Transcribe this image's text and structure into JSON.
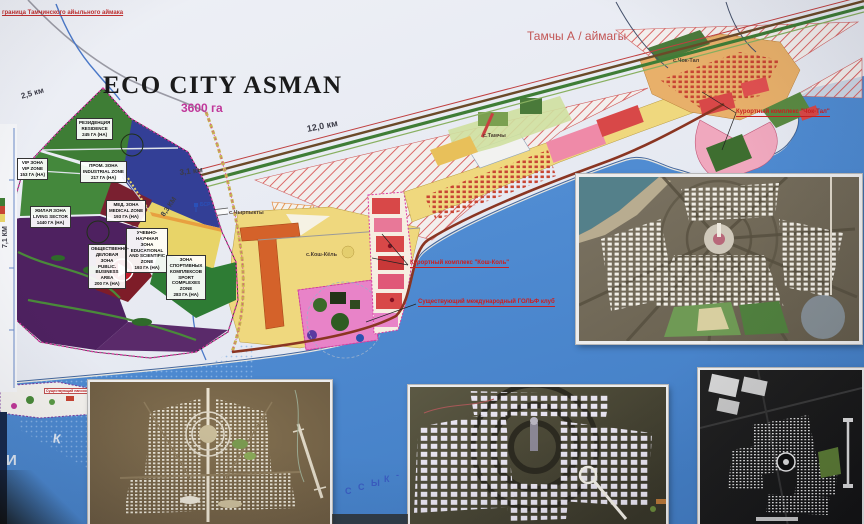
{
  "header": {
    "title": "ECO CITY ASMAN",
    "area": "3600 га",
    "region_label": "Тамчы А / аймагы",
    "boundary_note": "граница Тамчинского айыльного аймака"
  },
  "zones": {
    "residence": {
      "ru": "РЕЗИДЕНЦИЯ",
      "en": "RESIDENCE",
      "area": "245 ГА (НА)"
    },
    "vip": {
      "ru": "VIP ЗОНА",
      "en": "VIP ZONE",
      "area": "153 ГА (НА)"
    },
    "industrial": {
      "ru": "ПРОМ. ЗОНА",
      "en": "INDUSTRIAL ZONE",
      "area": "217 ГА (НА)"
    },
    "living": {
      "ru": "ЖИЛАЯ ЗОНА",
      "en": "LIVING SECTOR",
      "area": "1440 ГА (НА)"
    },
    "medical": {
      "ru": "МЕД. ЗОНА",
      "en": "MEDICAL ZONE",
      "area": "193 ГА (НА)"
    },
    "educational": {
      "ru": "УЧЕБНО-НАУЧНАЯ ЗОНА",
      "en": "EDUCATIONAL AND SCIENTIFIC ZONE",
      "area": "193 ГА (НА)"
    },
    "business": {
      "ru": "ОБЩЕСТВЕННО-ДЕЛОВАЯ ЗОНА",
      "en": "PUBLIC. BUSINESS AREA",
      "area": "200 ГА (НА)"
    },
    "sport": {
      "ru": "ЗОНА СПОРТИВНЫХ КОМПЛЕКСОВ",
      "en": "SPORT COMPLEXES ZONE",
      "area": "283 ГА (НА)"
    }
  },
  "distances": {
    "d25": "2,5 км",
    "d120": "12,0 км",
    "d31": "3,1 км",
    "d83": "8,3 КМ",
    "d71": "7,1 КМ"
  },
  "settlements": {
    "tamchy": "с.Тамчы",
    "chyrpykty": "с.Чырпыкты",
    "koshkol": "с.Кош-Кёль",
    "choktal": "с.Чок-Тал"
  },
  "annotations": {
    "choktal_resort": "Курортный комплекс \"Чок-Тал\"",
    "koshkol_resort": "Курортный комплекс \"Кош-Коль\"",
    "golf": "Существующий международный ГОЛЬФ клуб",
    "mir": "Существующий пансионат \"Мир\""
  },
  "markers": {
    "bsr": "БСР"
  },
  "lake": {
    "l1": "И",
    "l2": "К",
    "l3": "С",
    "l4": "С",
    "l5": "Ы",
    "l6": "К",
    "l7": "-"
  },
  "colors": {
    "lake": "#4a8bd4",
    "residence_green": "#3e7d35",
    "industrial_blue": "#333f96",
    "living_purple": "#4e2160",
    "educational_yellow": "#e8d468",
    "coast_yellow": "#efd87e",
    "resort_red": "#d84848",
    "golf_pink": "#e883c8",
    "annotation_red": "#cc2020",
    "boundary_magenta": "#d83aa0",
    "title_magenta": "#c0389a"
  }
}
